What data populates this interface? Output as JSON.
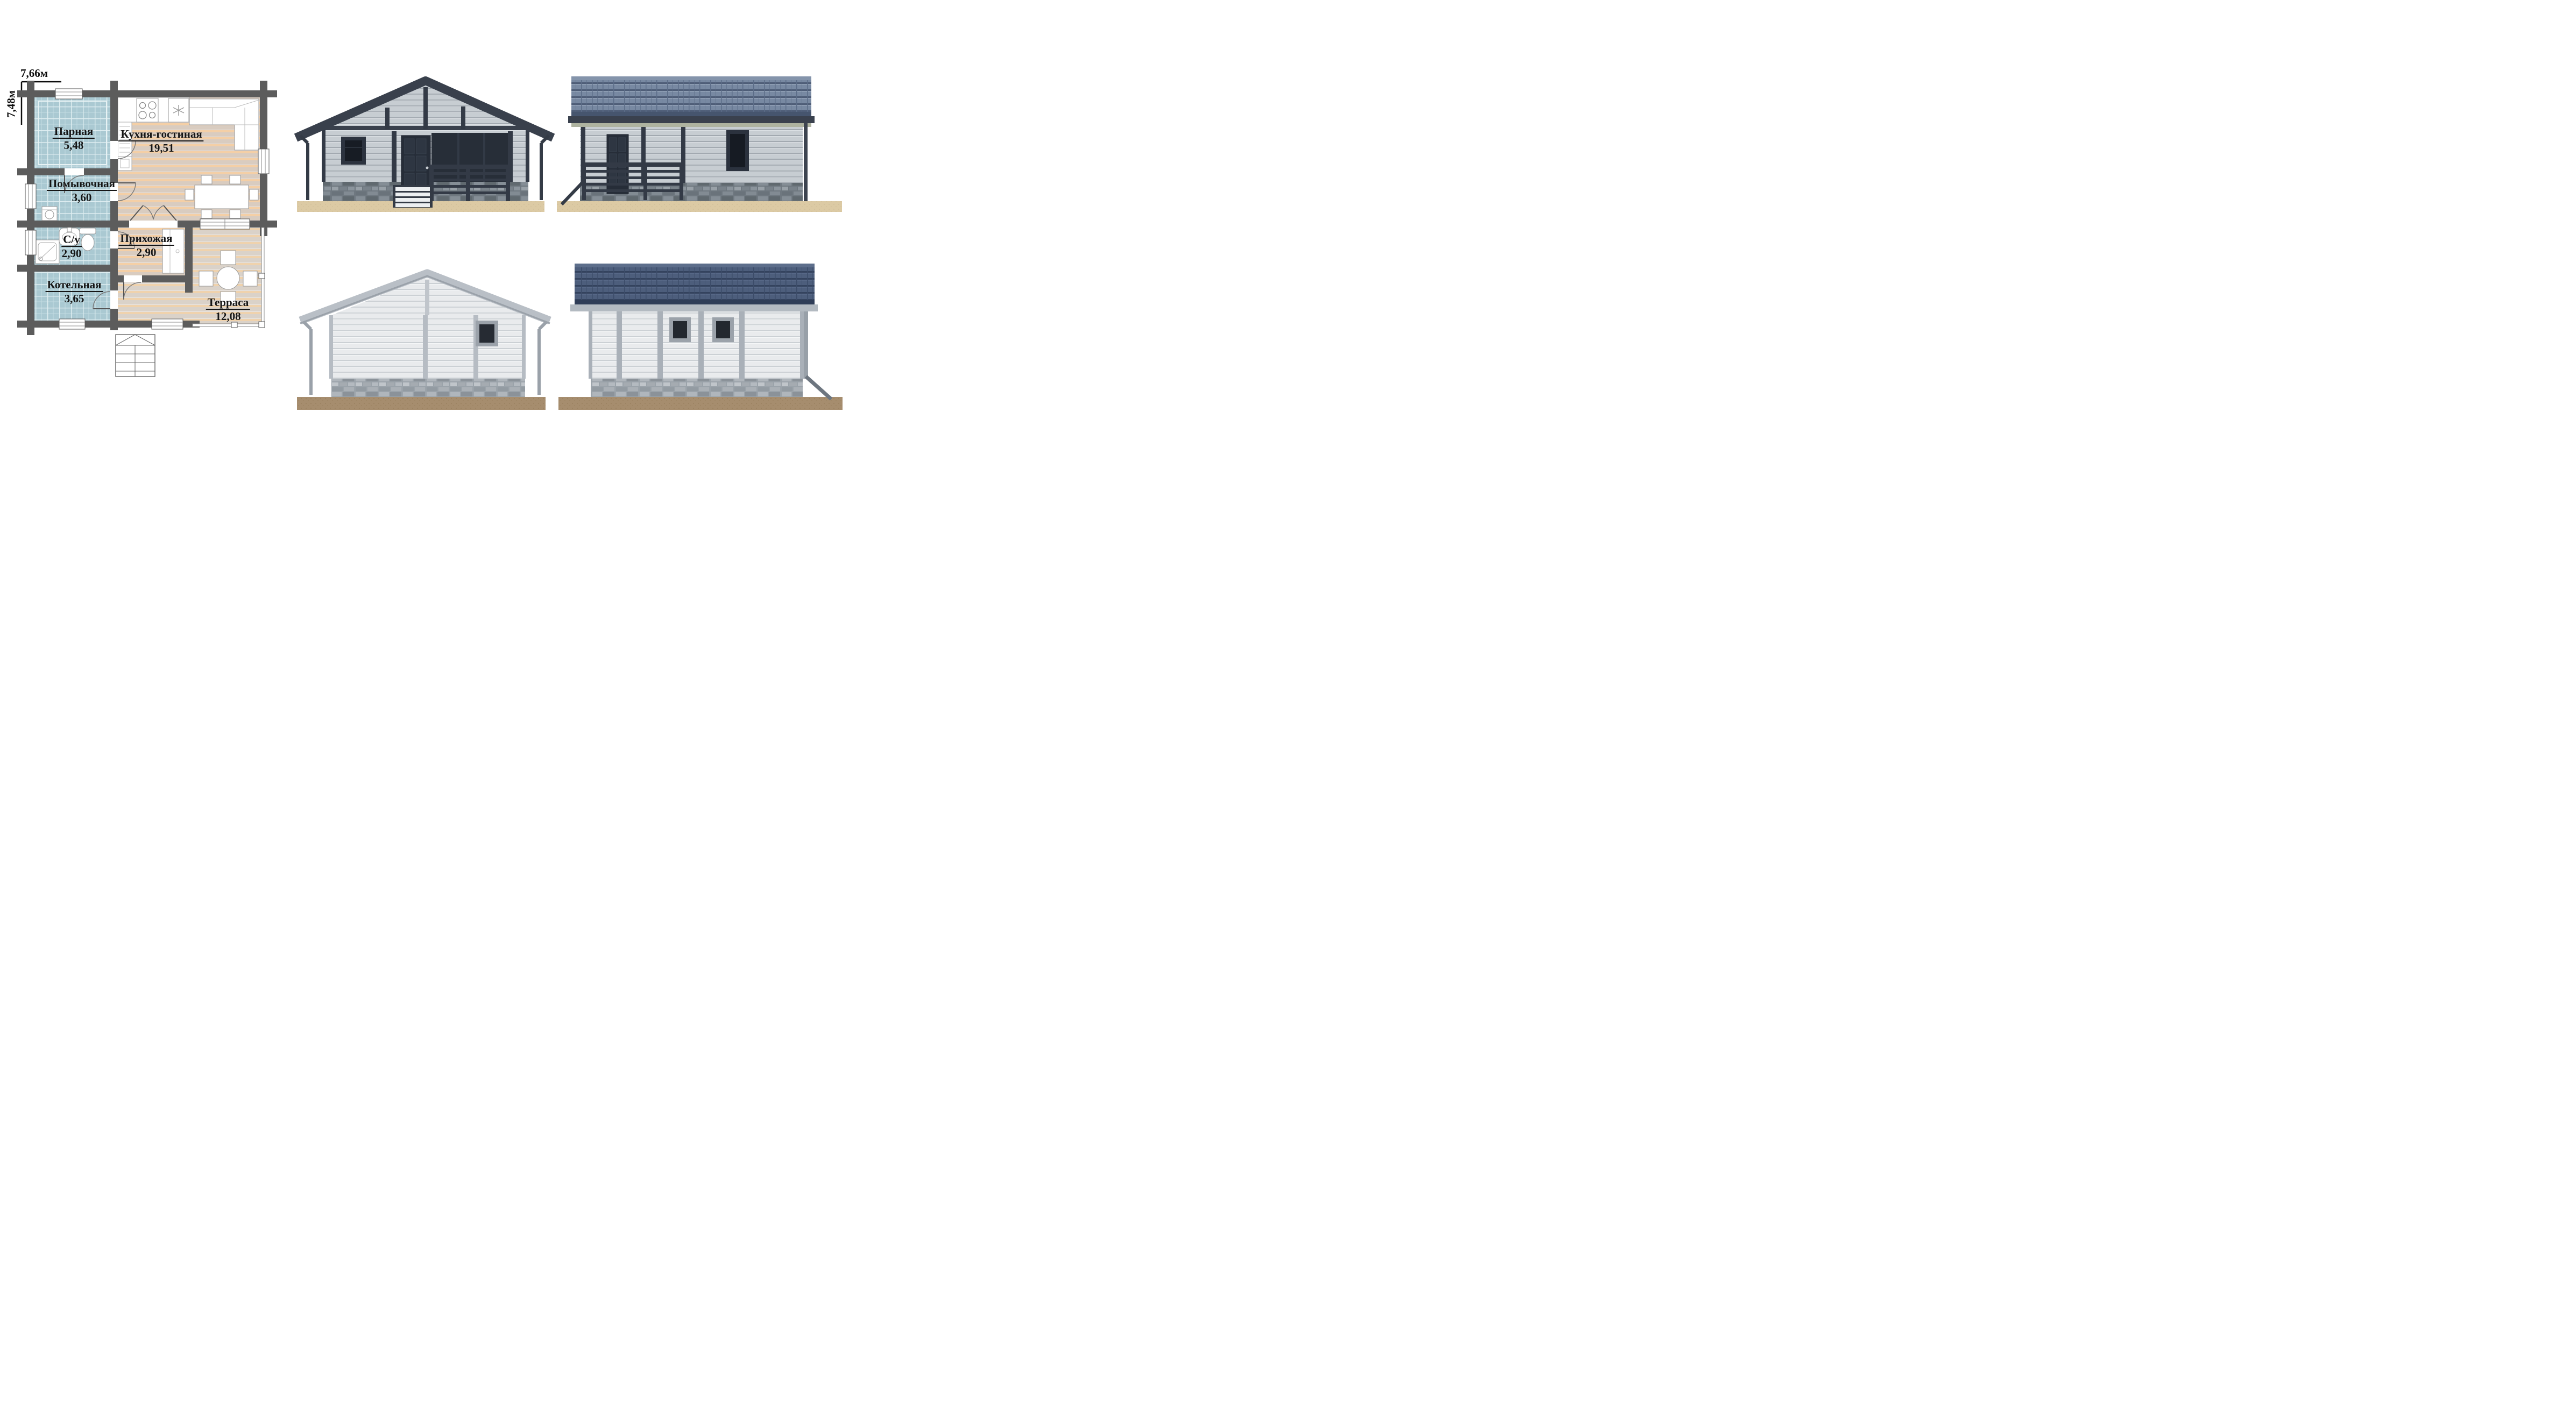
{
  "plan": {
    "width_label": "7,66м",
    "height_label": "7,48м",
    "rooms": [
      {
        "id": "parnaya",
        "name": "Парная",
        "area": "5,48"
      },
      {
        "id": "kuhnya-gostinaya",
        "name": "Кухня-гостиная",
        "area": "19,51"
      },
      {
        "id": "pomyvochnaya",
        "name": "Помывочная",
        "area": "3,60"
      },
      {
        "id": "sanuzel",
        "name": "С/у",
        "area": "2,90"
      },
      {
        "id": "prihozhaya",
        "name": "Прихожая",
        "area": "2,90"
      },
      {
        "id": "kotelnaya",
        "name": "Котельная",
        "area": "3,65"
      },
      {
        "id": "terrasa",
        "name": "Терраса",
        "area": "12,08"
      }
    ]
  },
  "renders": [
    {
      "id": "front-elevation"
    },
    {
      "id": "side-elevation-porch"
    },
    {
      "id": "rear-elevation"
    },
    {
      "id": "side-elevation-windows"
    }
  ],
  "colors": {
    "plan_wall": "#5c5c5c",
    "tile_room": "#aac9d2",
    "tile_grid": "#c3dce1",
    "wood_floor": "#d9ccc0",
    "wood_accent": "#f4cfa6",
    "roof_dark": "#39404c",
    "roof_tile_blue": "#7889a2",
    "roof_tile_dark_blue": "#4d5e7c",
    "roof_light": "#b9bfc6",
    "siding_gray": "#c7cdd2",
    "siding_light": "#e9ebed",
    "stone_dark": "#6f7880",
    "stone_light": "#9ba3aa",
    "ground_sand": "#dccaa4",
    "ground_soil": "#a68d6e",
    "label_text": "#151515"
  }
}
